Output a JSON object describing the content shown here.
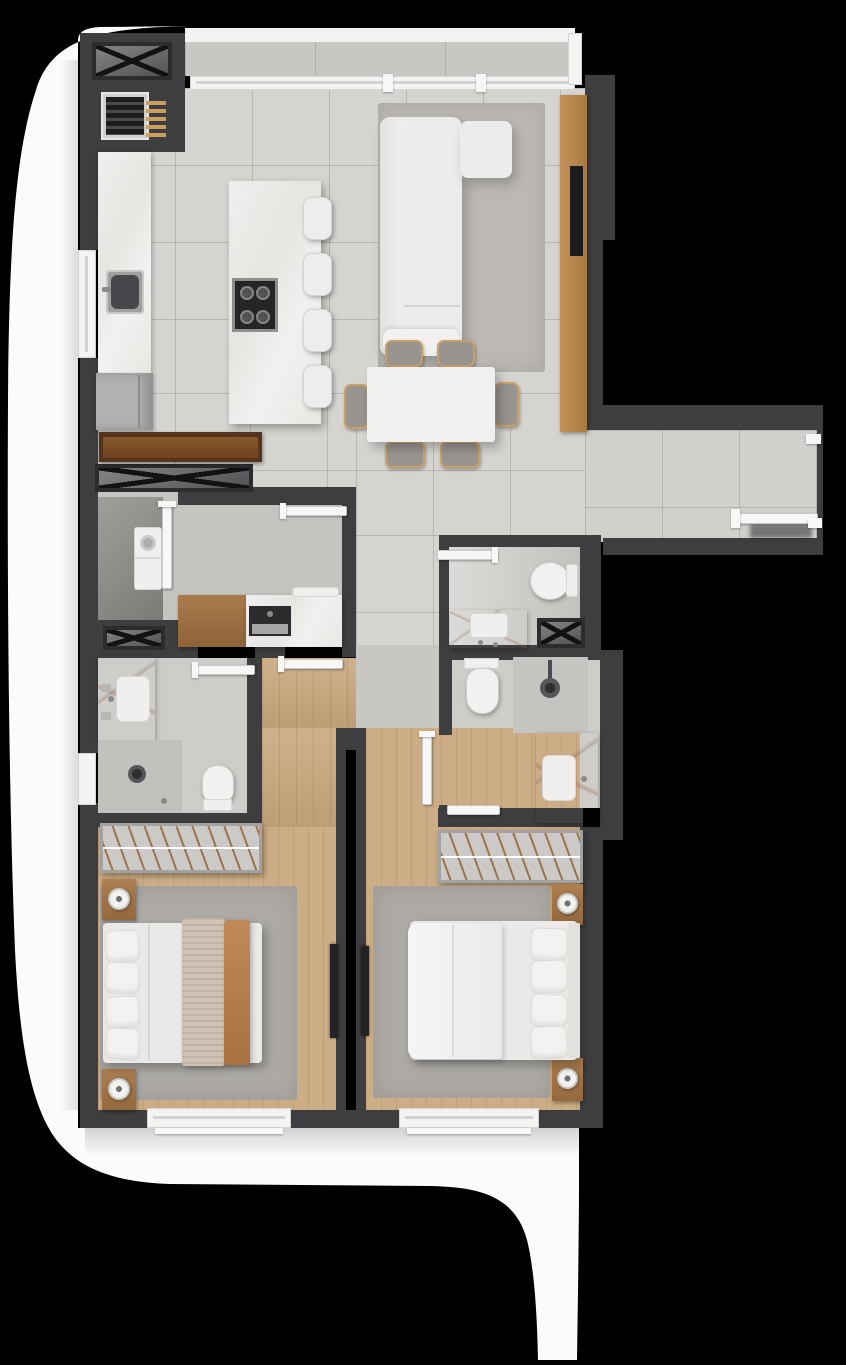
{
  "scene": {
    "title": "apartment-floor-plan-top-down-3d-render",
    "render_style": "photoreal top view, black background, white curved exterior walkway",
    "palette": {
      "background": "#000000",
      "wall": "#3e3e40",
      "tile_floor": "#d6d4d1",
      "service_floor": "#c6c4c1",
      "wood_floor": "#c9a87e",
      "rug": "#adaaa6",
      "marble": "#efeeec",
      "white_furniture": "#f0efed",
      "wood_furniture": "#b8894f",
      "walnut_shelf": "#59371d",
      "chair_accent": "#c8a169",
      "tv_screen": "#1b1b1d",
      "exterior_band": "#fbfbfa"
    },
    "rooms": [
      {
        "name": "kitchen",
        "furniture": [
          "vent-shaft",
          "water-heater-grille",
          "wall-counter-with-sink",
          "side-window",
          "tall-refrigerator-cabinet",
          "walnut-shelf-bench",
          "island-with-cooktop",
          "bar-stools"
        ]
      },
      {
        "name": "living-room",
        "furniture": [
          "l-shaped-sofa",
          "area-rug",
          "tv-console",
          "wall-tv",
          "panoramic-window"
        ]
      },
      {
        "name": "dining-area",
        "furniture": [
          "rectangular-table",
          "dining-chairs"
        ]
      },
      {
        "name": "entrance-hall",
        "furniture": [
          "entrance-door",
          "door-mat-shadow"
        ]
      },
      {
        "name": "service-area",
        "furniture": [
          "washer",
          "laundry-door",
          "utility-wood-cabinet",
          "utility-counter-with-sink",
          "vent-shaft-wide",
          "vent-shaft-small"
        ]
      },
      {
        "name": "powder-room",
        "furniture": [
          "toilet",
          "marble-washbasin-counter",
          "vent-shaft"
        ]
      },
      {
        "name": "hall-bathroom",
        "furniture": [
          "toilet",
          "glass-shower-with-rain-head",
          "marble-vanity-with-sink"
        ]
      },
      {
        "name": "ensuite-bathroom",
        "furniture": [
          "marble-vanity-with-sink",
          "glass-shower-with-window",
          "toilet"
        ]
      },
      {
        "name": "inner-hallway",
        "furniture": [
          "pocket-sliding-door-left",
          "pocket-sliding-door-right"
        ]
      },
      {
        "name": "bedroom-1",
        "furniture": [
          "open-wardrobe-with-hangers",
          "double-bed-with-throw-blankets",
          "nightstand-with-lamp-top",
          "nightstand-with-lamp-bottom",
          "area-rug",
          "window"
        ]
      },
      {
        "name": "bedroom-2",
        "furniture": [
          "open-wardrobe-with-hangers",
          "double-bed-white-bedding",
          "headboard",
          "nightstand-with-lamp-top",
          "nightstand-with-lamp-bottom",
          "area-rug",
          "window"
        ]
      },
      {
        "name": "exterior",
        "furniture": [
          "white-curved-walkway-band"
        ]
      }
    ],
    "counts": {
      "bedrooms": 2,
      "bathrooms": 3,
      "vent_shafts": 4,
      "cooktop_burners": 4,
      "bar_stools": 4,
      "dining_chairs": 6,
      "sofa_seat_cushions": 3,
      "bed_pillows_each": 4,
      "sliding_doors": 2,
      "swing_door_leaves": 8,
      "windows": 5
    }
  }
}
